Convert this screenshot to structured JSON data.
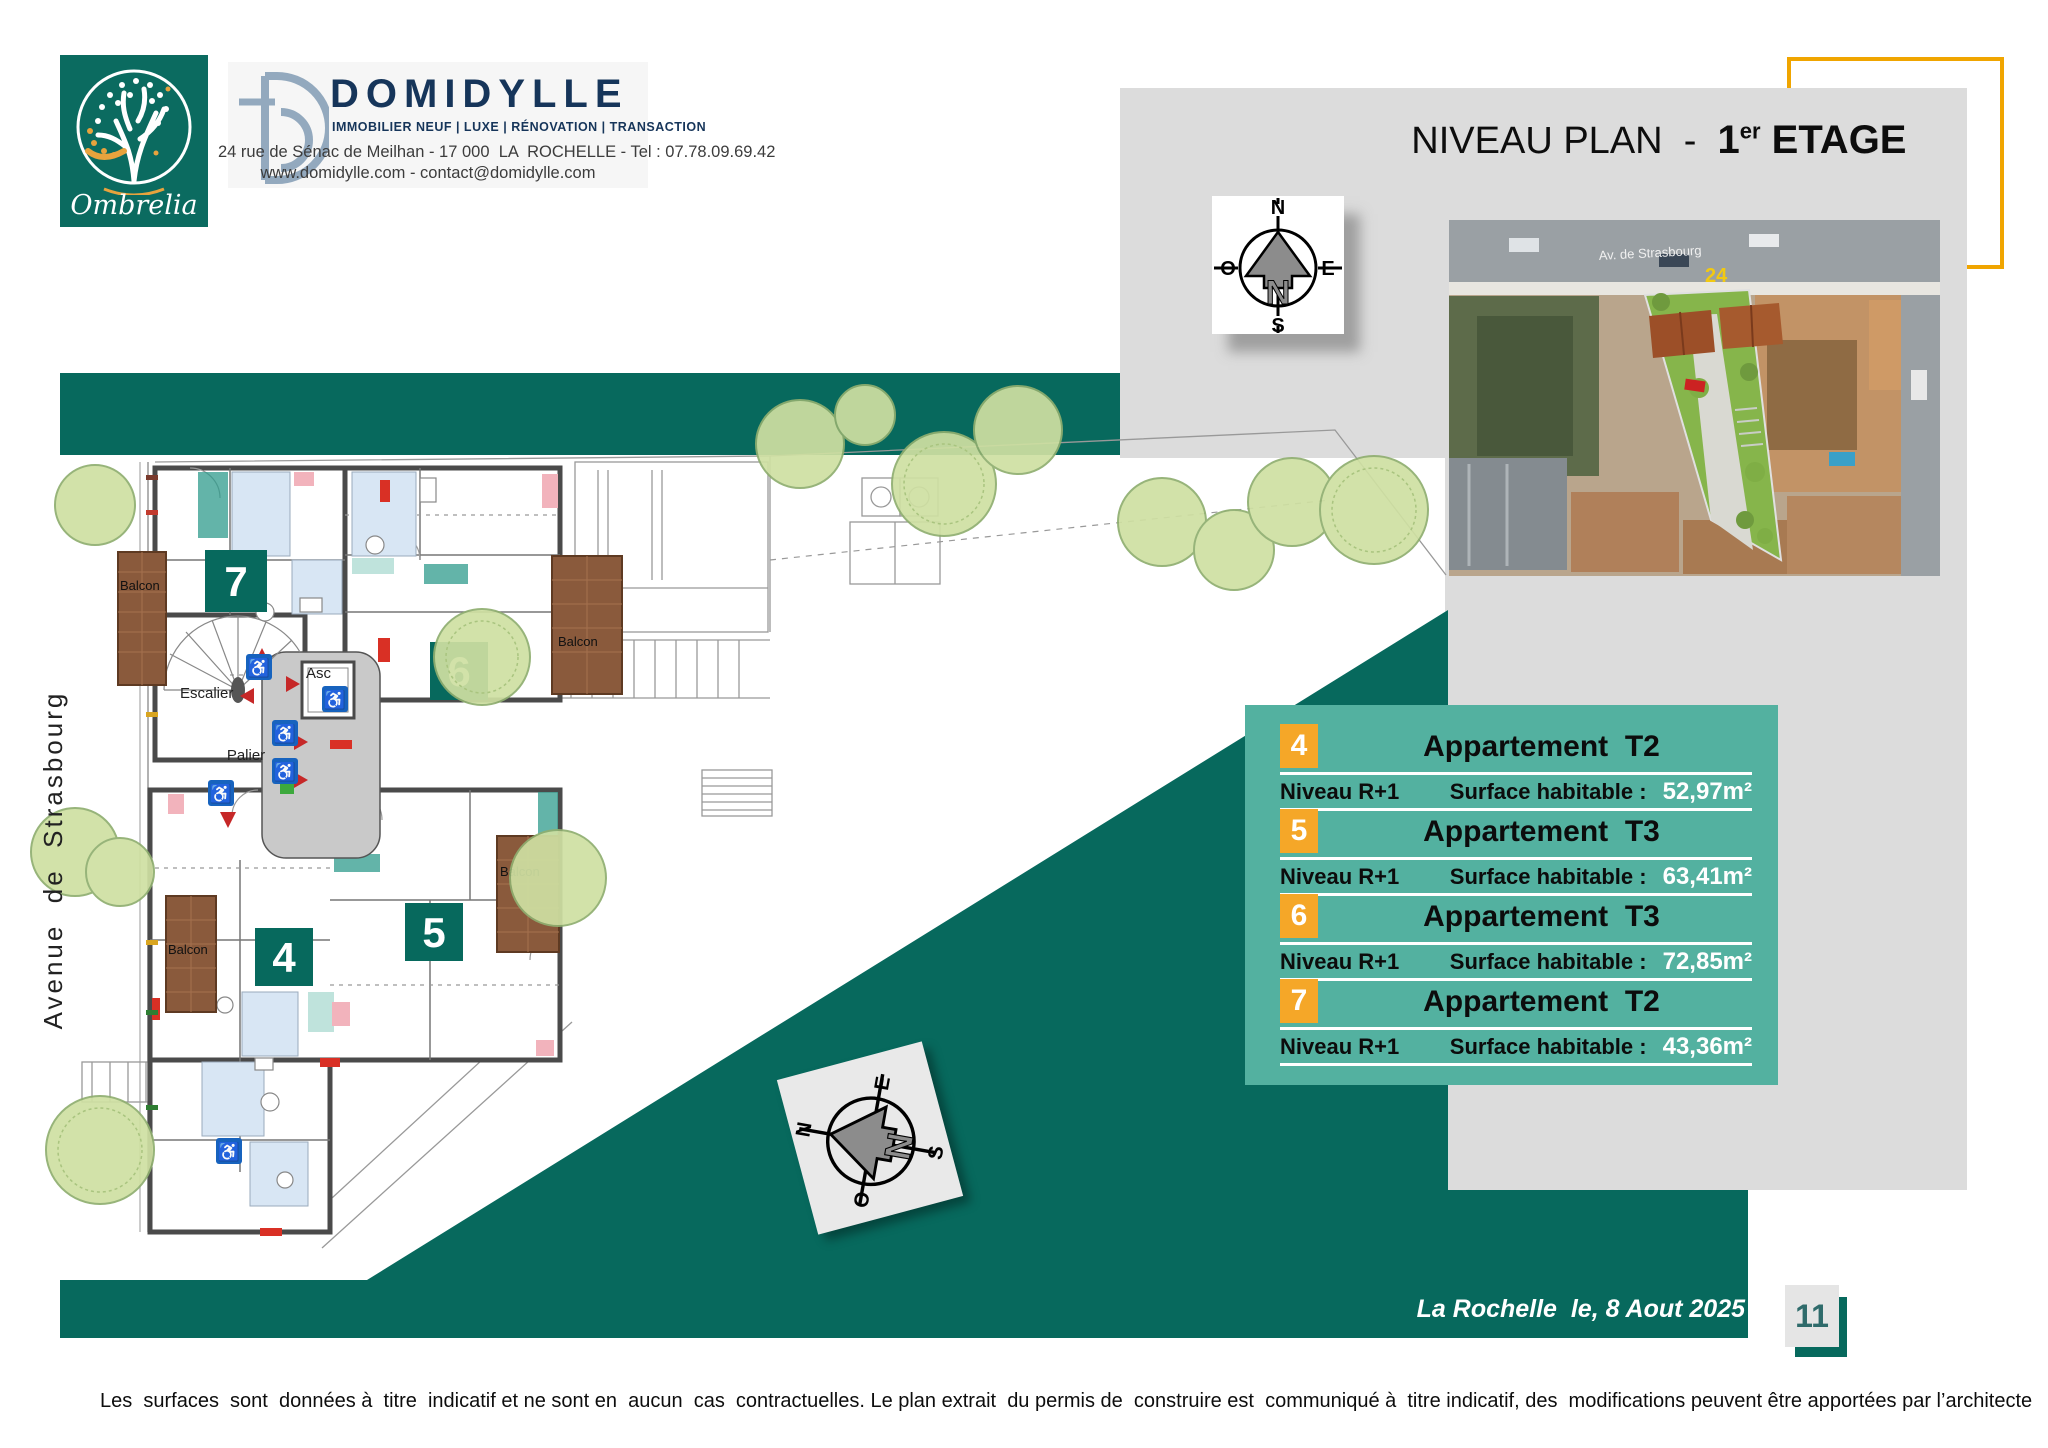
{
  "header": {
    "brand_name": "Ombrelia",
    "agency": {
      "name": "DOMIDYLLE",
      "tagline": "IMMOBILIER NEUF | LUXE | RÉNOVATION | TRANSACTION",
      "address_line1": "24 rue de Sénac de Meilhan - 17 000  LA  ROCHELLE - Tel : 07.78.09.69.42",
      "address_line2": "www.domidylle.com - contact@domidylle.com"
    },
    "title": {
      "prefix": "NIVEAU PLAN  -  ",
      "level_num": "1",
      "level_sup": "er",
      "level_word": " ETAGE"
    }
  },
  "compass": {
    "n": "N",
    "s": "S",
    "e": "E",
    "o": "O",
    "center": "N"
  },
  "aerial": {
    "street_label": "Av. de Strasbourg",
    "number": "24"
  },
  "plan": {
    "street_label": "Avenue  de  Strasbourg",
    "rooms": {
      "escalier": "Escalier",
      "asc": "Asc",
      "palier": "Palier",
      "balcon": "Balcon"
    },
    "units": [
      {
        "num": "7"
      },
      {
        "num": "6"
      },
      {
        "num": "5"
      },
      {
        "num": "4"
      }
    ]
  },
  "apartments": [
    {
      "num": "4",
      "title": "Appartement  T2",
      "level_label": "Niveau R+1",
      "surface_label": "Surface habitable :",
      "surface_value": "52,97m²"
    },
    {
      "num": "5",
      "title": "Appartement  T3",
      "level_label": "Niveau R+1",
      "surface_label": "Surface habitable :",
      "surface_value": "63,41m²"
    },
    {
      "num": "6",
      "title": "Appartement  T3",
      "level_label": "Niveau R+1",
      "surface_label": "Surface habitable :",
      "surface_value": "72,85m²"
    },
    {
      "num": "7",
      "title": "Appartement  T2",
      "level_label": "Niveau R+1",
      "surface_label": "Surface habitable :",
      "surface_value": "43,36m²"
    }
  ],
  "footer": {
    "date_line": "La Rochelle  le, 8 Aout 2025",
    "page_number": "11",
    "disclaimer": "Les  surfaces  sont  données à  titre  indicatif et ne sont en  aucun  cas  contractuelles. Le plan extrait  du permis de  construire est  communiqué à  titre indicatif, des  modifications peuvent être apportées par l’architecte"
  },
  "colors": {
    "teal_dark": "#07695D",
    "teal_table": "#53B1A0",
    "badge_orange": "#F5A728",
    "navy": "#16355A",
    "logo_slate": "#93A9BE",
    "bracket_yellow": "#F0A500",
    "panel_gray": "#DCDCDC"
  }
}
